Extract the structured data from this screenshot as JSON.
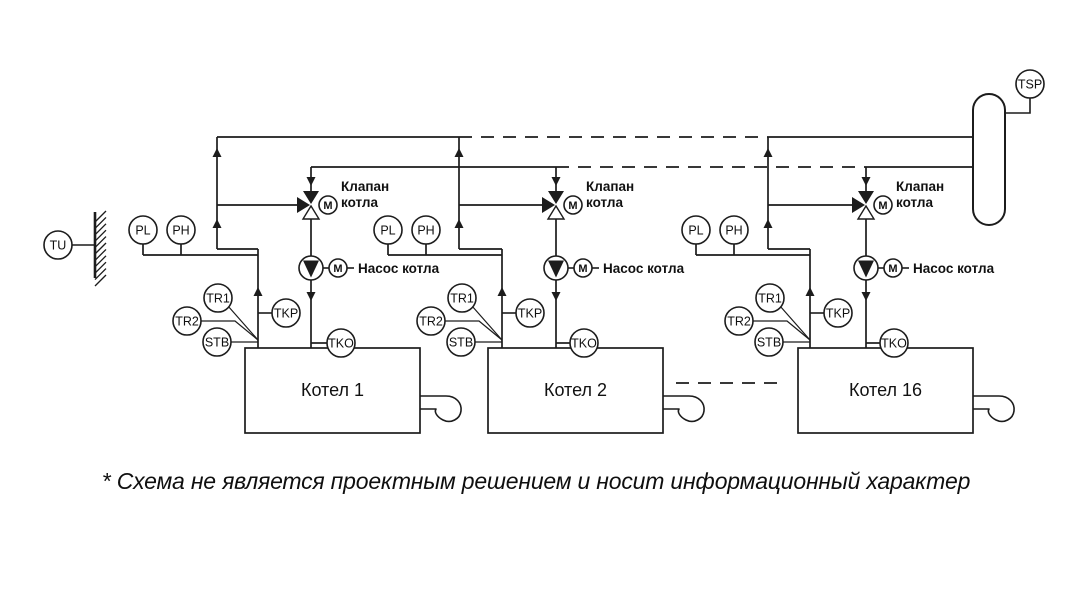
{
  "disclaimer": "* Схема не является проектным решением и носит информационный характер",
  "labels": {
    "valve": "Клапан котла",
    "valve_line1": "Клапан",
    "valve_line2": "котла",
    "pump": "Насос котла",
    "motor": "M"
  },
  "outdoor_sensor": {
    "tag": "TU"
  },
  "header_sensor": {
    "tag": "TSP"
  },
  "boilers": [
    {
      "id": "boiler-1",
      "name": "Котел 1",
      "sensors": {
        "pl": "PL",
        "ph": "PH",
        "tr1": "TR1",
        "tr2": "TR2",
        "stb": "STB",
        "tkp": "TKP",
        "tko": "TKO"
      }
    },
    {
      "id": "boiler-2",
      "name": "Котел 2",
      "sensors": {
        "pl": "PL",
        "ph": "PH",
        "tr1": "TR1",
        "tr2": "TR2",
        "stb": "STB",
        "tkp": "TKP",
        "tko": "TKO"
      }
    },
    {
      "id": "boiler-16",
      "name": "Котел 16",
      "sensors": {
        "pl": "PL",
        "ph": "PH",
        "tr1": "TR1",
        "tr2": "TR2",
        "stb": "STB",
        "tkp": "TKP",
        "tko": "TKO"
      }
    }
  ],
  "colors": {
    "line": "#1c1c1c",
    "text": "#111111",
    "background": "#ffffff"
  }
}
